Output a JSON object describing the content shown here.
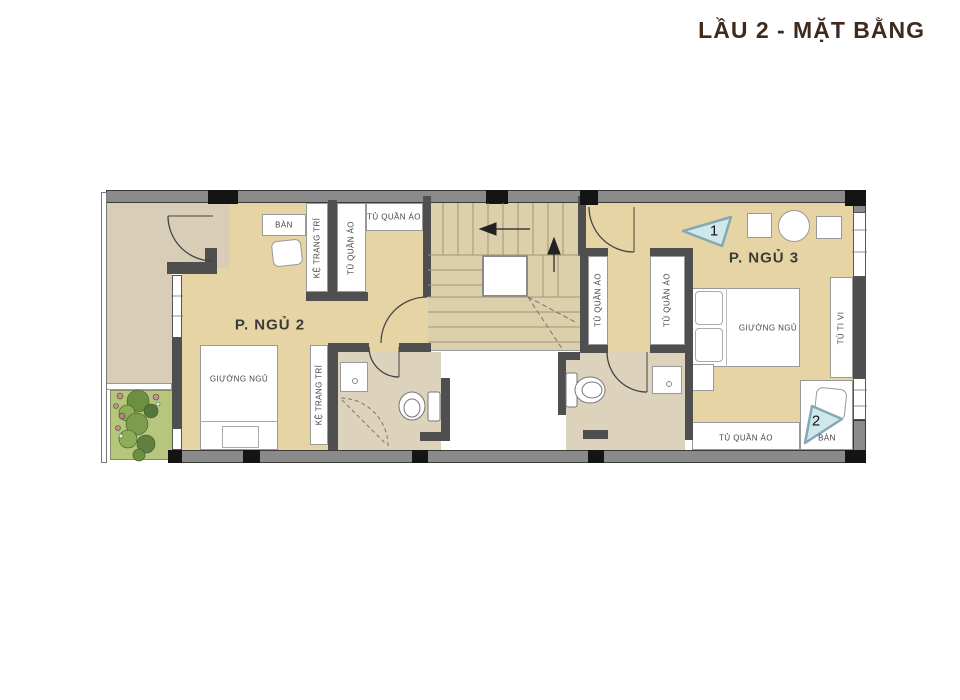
{
  "title": "LẦU 2 -  MẶT BẰNG",
  "palette": {
    "floor_tan": "#e7d4a4",
    "floor_stairs": "#dccfab",
    "floor_bath": "#ddd2bc",
    "balcony": "#d8cdb6",
    "garden_green": "#b6c77d",
    "wall_grey": "#8a8a8a",
    "wall_dark": "#4f4f4f",
    "column_black": "#141414",
    "marker_fill": "#cfe9eb",
    "marker_stroke": "#85a8b2",
    "title_color": "#3f2b1e"
  },
  "rooms": {
    "bedroom2": {
      "label": "P. NGỦ 2"
    },
    "bedroom3": {
      "label": "P. NGỦ 3"
    }
  },
  "furniture": {
    "desk_bedroom2": "BÀN",
    "desk_bedroom3": "BÀN",
    "shelf_upper": "KỆ TRANG TRÍ",
    "shelf_lower": "KỆ TRANG TRÍ",
    "wardrobe_bedroom2_side": "TỦ QUẦN ÁO",
    "wardrobe_bedroom2_top": "TỦ QUẦN ÁO",
    "wardrobe_hall_left": "TỦ QUẦN ÁO",
    "wardrobe_hall_right": "TỦ QUẦN ÁO",
    "wardrobe_bedroom3": "TỦ QUẦN ÁO",
    "bed_bedroom2": "GIƯỜNG NGỦ",
    "bed_bedroom3": "GIƯỜNG NGỦ",
    "tv_cabinet": "TỦ TI VI"
  },
  "markers": {
    "view1": "1",
    "view2": "2"
  }
}
